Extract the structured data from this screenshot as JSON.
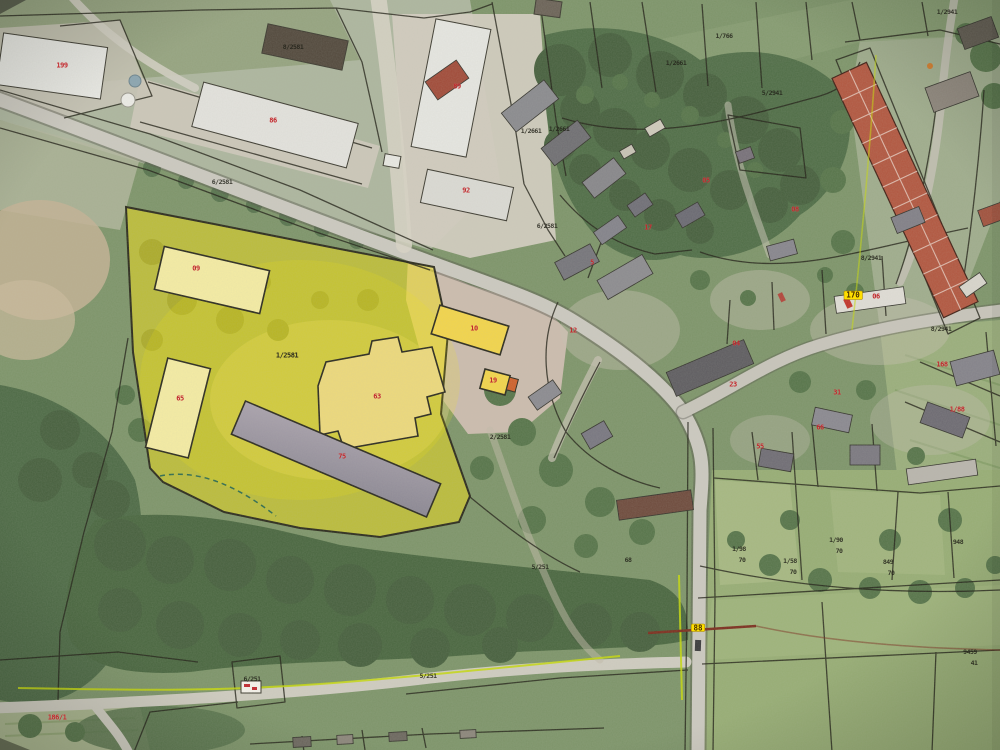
{
  "map": {
    "kind": "aerial-cadastral-orthophoto",
    "colors": {
      "highlight_parcel": "#f4e112",
      "boundary_line": "#201f15",
      "building_label": "#c1272d",
      "parcel_label": "#23231a",
      "road_marker_bg": "#ffdf00",
      "survey_line_green": "#c6d80a",
      "survey_line_red": "#7c2d1d"
    },
    "labels": [
      {
        "text": "199",
        "x": 62,
        "y": 66,
        "kind": "building-label"
      },
      {
        "text": "86",
        "x": 273,
        "y": 121,
        "kind": "building-label"
      },
      {
        "text": "89",
        "x": 457,
        "y": 87,
        "kind": "building-label"
      },
      {
        "text": "92",
        "x": 466,
        "y": 191,
        "kind": "building-label"
      },
      {
        "text": "09",
        "x": 196,
        "y": 269,
        "kind": "building-label"
      },
      {
        "text": "65",
        "x": 180,
        "y": 399,
        "kind": "building-label"
      },
      {
        "text": "63",
        "x": 377,
        "y": 397,
        "kind": "building-label"
      },
      {
        "text": "75",
        "x": 342,
        "y": 457,
        "kind": "building-label"
      },
      {
        "text": "10",
        "x": 474,
        "y": 329,
        "kind": "building-label"
      },
      {
        "text": "19",
        "x": 493,
        "y": 381,
        "kind": "building-label"
      },
      {
        "text": "12",
        "x": 573,
        "y": 331,
        "kind": "building-label"
      },
      {
        "text": "05",
        "x": 706,
        "y": 181,
        "kind": "building-label"
      },
      {
        "text": "08",
        "x": 795,
        "y": 210,
        "kind": "building-label"
      },
      {
        "text": "5",
        "x": 592,
        "y": 263,
        "kind": "building-label"
      },
      {
        "text": "17",
        "x": 648,
        "y": 228,
        "kind": "building-label"
      },
      {
        "text": "04",
        "x": 736,
        "y": 344,
        "kind": "building-label"
      },
      {
        "text": "23",
        "x": 733,
        "y": 385,
        "kind": "building-label"
      },
      {
        "text": "31",
        "x": 837,
        "y": 393,
        "kind": "building-label"
      },
      {
        "text": "66",
        "x": 820,
        "y": 428,
        "kind": "building-label"
      },
      {
        "text": "06",
        "x": 876,
        "y": 297,
        "kind": "building-label"
      },
      {
        "text": "168",
        "x": 942,
        "y": 365,
        "kind": "building-label"
      },
      {
        "text": "1/88",
        "x": 957,
        "y": 410,
        "kind": "building-label"
      },
      {
        "text": "55",
        "x": 760,
        "y": 447,
        "kind": "building-label"
      },
      {
        "text": "186/1",
        "x": 57,
        "y": 718,
        "kind": "building-label"
      },
      {
        "text": "8/2581",
        "x": 293,
        "y": 47,
        "kind": "parcel-label"
      },
      {
        "text": "6/2581",
        "x": 222,
        "y": 182,
        "kind": "parcel-label"
      },
      {
        "text": "1/2661",
        "x": 531,
        "y": 131,
        "kind": "parcel-label"
      },
      {
        "text": "1/2661",
        "x": 559,
        "y": 129,
        "kind": "parcel-label"
      },
      {
        "text": "6/2581",
        "x": 547,
        "y": 226,
        "kind": "parcel-label"
      },
      {
        "text": "1/2581",
        "x": 287,
        "y": 356,
        "kind": "parcel-label-bold"
      },
      {
        "text": "2/2581",
        "x": 500,
        "y": 437,
        "kind": "parcel-label"
      },
      {
        "text": "1/2661",
        "x": 676,
        "y": 63,
        "kind": "parcel-label"
      },
      {
        "text": "1/766",
        "x": 724,
        "y": 36,
        "kind": "parcel-label"
      },
      {
        "text": "5/2941",
        "x": 772,
        "y": 93,
        "kind": "parcel-label"
      },
      {
        "text": "1/2941",
        "x": 947,
        "y": 12,
        "kind": "parcel-label"
      },
      {
        "text": "8/2941",
        "x": 871,
        "y": 258,
        "kind": "parcel-label"
      },
      {
        "text": "8/2941",
        "x": 941,
        "y": 329,
        "kind": "parcel-label"
      },
      {
        "text": "68",
        "x": 628,
        "y": 560,
        "kind": "parcel-label"
      },
      {
        "text": "5/251",
        "x": 540,
        "y": 567,
        "kind": "parcel-label"
      },
      {
        "text": "6/251",
        "x": 252,
        "y": 679,
        "kind": "parcel-label"
      },
      {
        "text": "5/251",
        "x": 428,
        "y": 676,
        "kind": "parcel-label"
      },
      {
        "text": "1/98",
        "x": 739,
        "y": 549,
        "kind": "parcel-label"
      },
      {
        "text": "70",
        "x": 742,
        "y": 560,
        "kind": "parcel-label"
      },
      {
        "text": "1/58",
        "x": 790,
        "y": 561,
        "kind": "parcel-label"
      },
      {
        "text": "70",
        "x": 793,
        "y": 572,
        "kind": "parcel-label"
      },
      {
        "text": "1/90",
        "x": 836,
        "y": 540,
        "kind": "parcel-label"
      },
      {
        "text": "70",
        "x": 839,
        "y": 551,
        "kind": "parcel-label"
      },
      {
        "text": "849",
        "x": 888,
        "y": 562,
        "kind": "parcel-label"
      },
      {
        "text": "70",
        "x": 891,
        "y": 573,
        "kind": "parcel-label"
      },
      {
        "text": "948",
        "x": 958,
        "y": 542,
        "kind": "parcel-label"
      },
      {
        "text": "9459",
        "x": 970,
        "y": 652,
        "kind": "parcel-label"
      },
      {
        "text": "41",
        "x": 974,
        "y": 663,
        "kind": "parcel-label"
      },
      {
        "text": "88",
        "x": 698,
        "y": 628,
        "kind": "road-label-highlight"
      },
      {
        "text": "170",
        "x": 853,
        "y": 295,
        "kind": "road-label-highlight"
      }
    ]
  }
}
